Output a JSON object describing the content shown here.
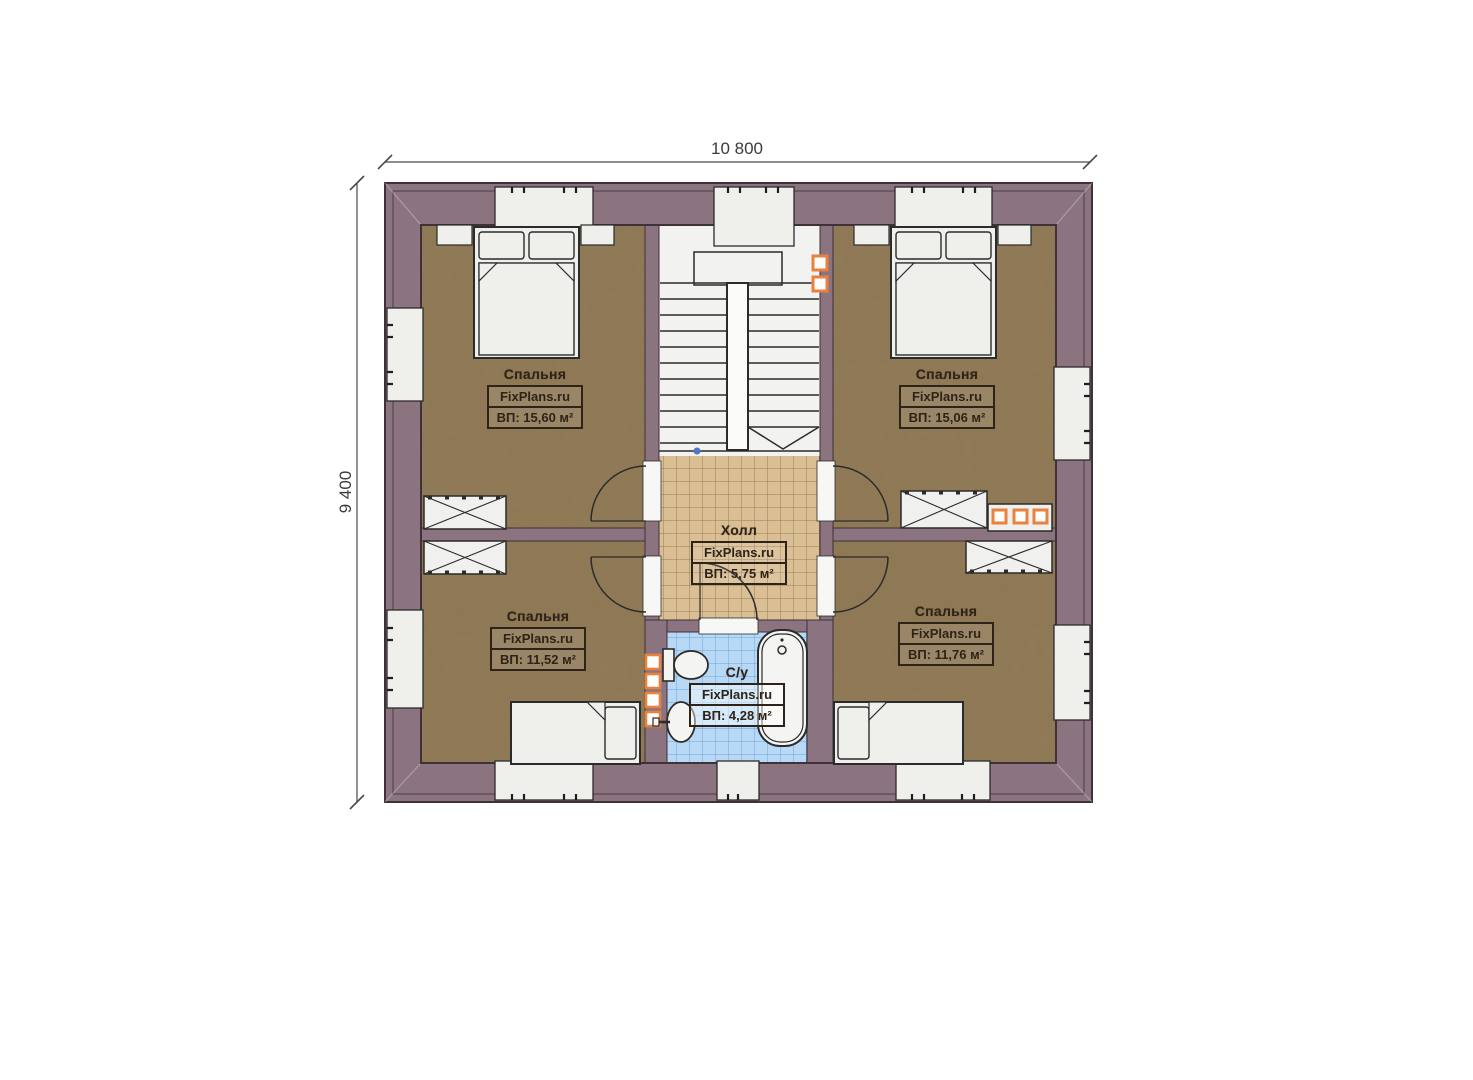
{
  "plan": {
    "dimensions": {
      "width_label": "10 800",
      "height_label": "9 400"
    },
    "watermark": "FixPlans.ru",
    "rooms": [
      {
        "id": "bedroom-top-left",
        "name": "Спальня",
        "watermark": "FixPlans.ru",
        "area": "ВП: 15,60 м²"
      },
      {
        "id": "bedroom-top-right",
        "name": "Спальня",
        "watermark": "FixPlans.ru",
        "area": "ВП: 15,06 м²"
      },
      {
        "id": "hall",
        "name": "Холл",
        "watermark": "FixPlans.ru",
        "area": "ВП: 5,75 м²"
      },
      {
        "id": "bathroom",
        "name": "С/у",
        "watermark": "FixPlans.ru",
        "area": "ВП: 4,28 м²"
      },
      {
        "id": "bedroom-bottom-left",
        "name": "Спальня",
        "watermark": "FixPlans.ru",
        "area": "ВП: 11,52 м²"
      },
      {
        "id": "bedroom-bottom-right",
        "name": "Спальня",
        "watermark": "FixPlans.ru",
        "area": "ВП: 11,76 м²"
      }
    ],
    "colors": {
      "wall": "#8b7380",
      "bedroom_floor": "#8f7854",
      "hall_floor": "#d9bf93",
      "bathroom_floor": "#b7d9f6",
      "fixture_white": "#f2f2f0",
      "outline": "#2b2b2b",
      "chimney_accent": "#e8823e"
    }
  }
}
